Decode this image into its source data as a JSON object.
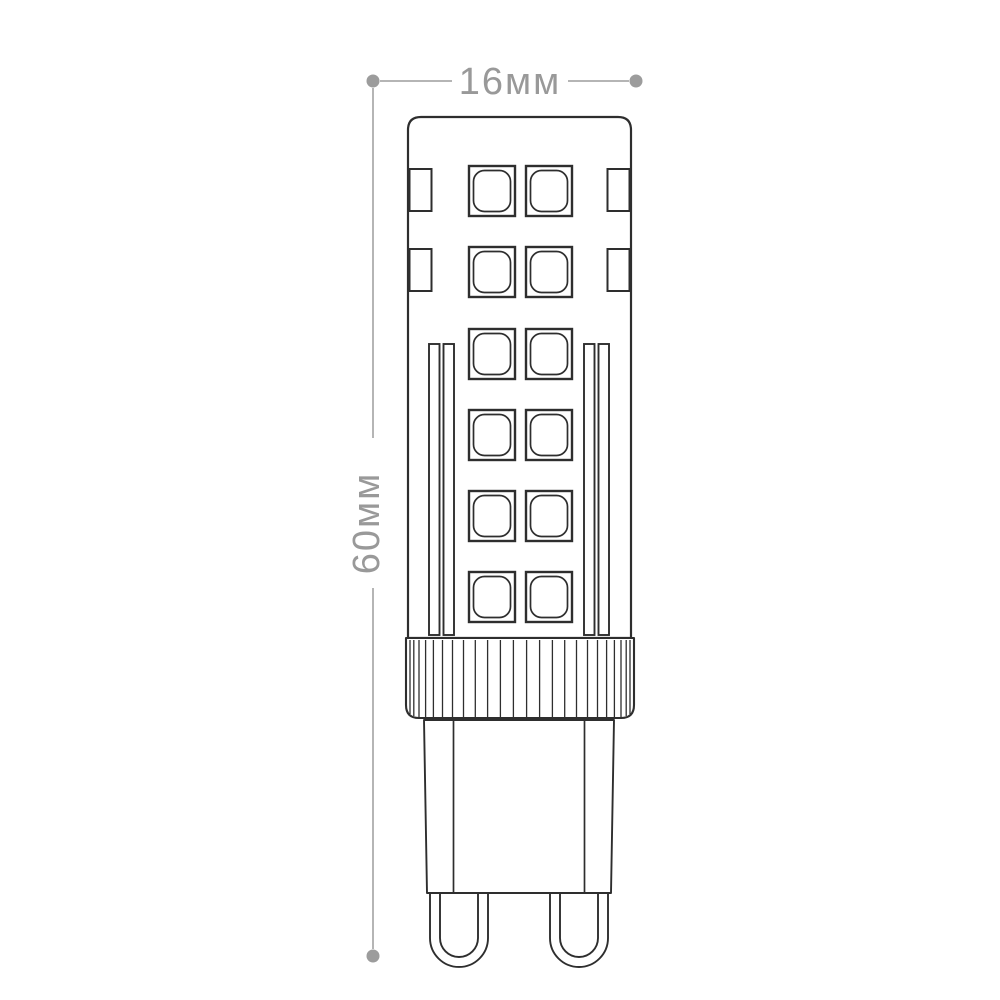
{
  "window": {
    "background": "#ffffff"
  },
  "diagram": {
    "dimension_width": {
      "label": "16мм",
      "value": "16",
      "unit": "мм"
    },
    "dimension_height": {
      "label": "60мм",
      "value": "60",
      "unit": "мм"
    },
    "style": {
      "outline_color": "#2e2e2e",
      "fill_color": "#ffffff",
      "dimension_line_color": "#b5b5b5",
      "dimension_dot_color": "#9c9c9c",
      "dimension_text_color": "#999999"
    },
    "drawing": {
      "led_chip_rows": 6,
      "led_chips_per_row": 2,
      "side_chip_rows": 2,
      "lens_ridge_strips_per_side": 2,
      "pin_count": 2
    }
  }
}
